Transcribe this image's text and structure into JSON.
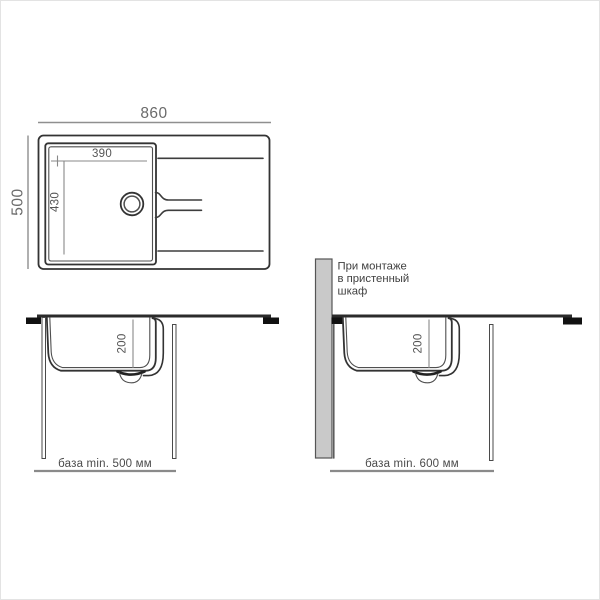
{
  "colors": {
    "outline": "#333333",
    "dimension_line": "#8f8f8f",
    "dimension_text": "#555555",
    "countertop": "#2b2b2b",
    "clamp": "#111111",
    "wall_panel_fill": "#c9c9c9",
    "background": "#ffffff"
  },
  "top_view": {
    "overall_width": "860",
    "overall_depth": "500",
    "bowl_width": "390",
    "bowl_length": "430"
  },
  "section_standard": {
    "bowl_depth": "200",
    "base_label": "база min. 500 мм"
  },
  "section_wall_cabinet": {
    "bowl_depth": "200",
    "base_label": "база min. 600 мм",
    "note_line1": "При монтаже",
    "note_line2": "в пристенный",
    "note_line3": "шкаф"
  }
}
